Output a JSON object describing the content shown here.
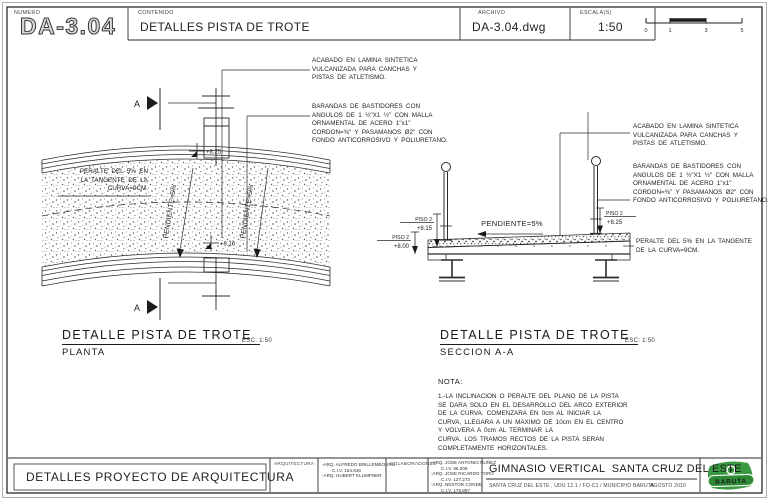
{
  "header": {
    "numero_label": "NUMERO",
    "numero": "DA-3.04",
    "contenido_label": "CONTENIDO",
    "contenido": "DETALLES PISTA DE TROTE",
    "archivo_label": "ARCHIVO",
    "archivo": "DA-3.04.dwg",
    "escala_label": "ESCALA(S)",
    "escala": "1:50",
    "scalebar": [
      "0",
      "1",
      "3",
      "5"
    ]
  },
  "plan": {
    "title": "DETALLE PISTA DE TROTE",
    "subtitle": "PLANTA",
    "esc": "ESC: 1:50",
    "section_marker": "A",
    "slope_label": "PENDIENTE=5%",
    "elev_top": "+8.25",
    "elev_bottom": "+8.16",
    "peralte_lines": [
      "PERALTE DEL 5% EN",
      "LA TANGENTE DE LA",
      "CURVA=9CM."
    ]
  },
  "section": {
    "title": "DETALLE PISTA DE TROTE",
    "subtitle": "SECCION A-A",
    "esc": "ESC: 1:50",
    "slope_label": "PENDIENTE=5%",
    "levels": [
      {
        "name": "PISO 2",
        "elev": "+8.15"
      },
      {
        "name": "PISO 2",
        "elev": "+8.00"
      },
      {
        "name": "PISO 2",
        "elev": "+8.25"
      }
    ]
  },
  "ann": {
    "acabado": [
      "ACABADO EN LAMINA SINTETICA",
      "VULCANIZADA PARA CANCHAS Y",
      "PISTAS DE ATLETISMO."
    ],
    "barandas": [
      "BARANDAS DE BASTIDORES CON",
      "ANGULOS DE 1 ½\"X1 ½\" CON MALLA",
      "ORNAMENTAL DE ACERO 1\"x1\"",
      "CORDON=⅜\" Y PASAMANOS Ø2\" CON",
      "FONDO ANTICORROSIVO Y POLIURETANO."
    ],
    "peralte": [
      "PERALTE DEL 5% EN LA TANGENTE",
      "DE LA CURVA=9CM."
    ]
  },
  "nota": {
    "label": "NOTA:",
    "lines": [
      "1.-LA INCLINACION O PERALTE DEL PLANO DE LA PISTA",
      "SE DARA SOLO EN EL DESARROLLO DEL ARCO EXTERIOR",
      "DE LA CURVA. COMENZARA EN 0cm AL INICIAR LA",
      "CURVA, LLEGARA A UN MAXIMO DE 10cm EN EL CENTRO",
      "Y VOLVERA A 0cm AL TERMINAR LA",
      "CURVA. LOS TRAMOS RECTOS DE LA PISTA SERAN",
      "COMPLETAMENTE HORIZONTALES."
    ]
  },
  "titleblock": {
    "left_title": "DETALLES PROYECTO DE ARQUITECTURA",
    "arquitectura_label": "ARQUITECTURA",
    "arquitectura": [
      "-ARQ. ALFREDO BRILLEMBOURG",
      "C.I.V. 154.846",
      "-ARQ. HUBERT KLUMPNER"
    ],
    "colaboradores_label": "COLABORADORES",
    "colaboradores": [
      "-ARQ. JOSE ANTONIO NUÑEZ",
      "C.I.V. 96.206",
      "-ARQ. JOSE RICARDO TORO",
      "C.I.V. 127.273",
      "-ARQ. NESTOR CONDE",
      "C.I.V. 175.887"
    ],
    "project": "GIMNASIO VERTICAL  SANTA CRUZ DEL ESTE",
    "location": "SANTA CRUZ DEL ESTE , UDU 12.1 / FO-C1 / MUNICIPIO BARUTA",
    "date": "AGOSTO 2010",
    "logo_text": "BARUTA"
  },
  "colors": {
    "line": "#2b2b2b",
    "logo_green": "#3a9a41",
    "logo_dark_green": "#2f8a36"
  }
}
